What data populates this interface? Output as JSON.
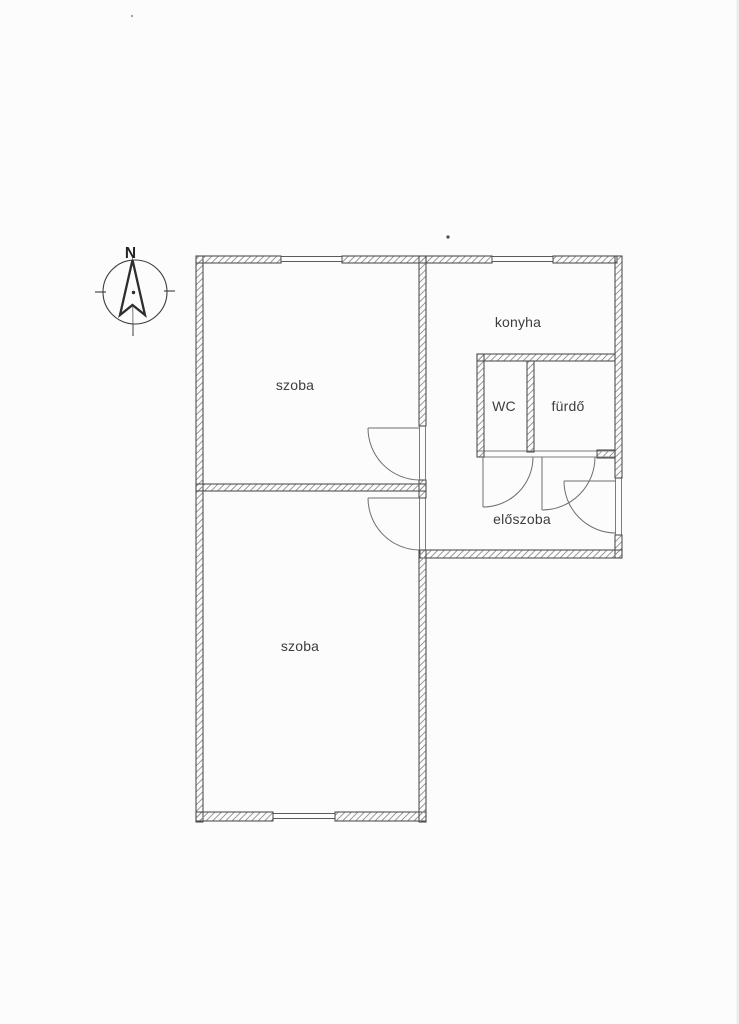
{
  "page": {
    "background": "#fcfcfc",
    "ink": "#3d3d3d",
    "wall_hatch_color": "#8f8f8f"
  },
  "compass": {
    "north_label": "N"
  },
  "rooms": [
    {
      "id": "szoba-1",
      "label": "szoba"
    },
    {
      "id": "szoba-2",
      "label": "szoba"
    },
    {
      "id": "konyha",
      "label": "konyha"
    },
    {
      "id": "wc",
      "label": "WC"
    },
    {
      "id": "furdo",
      "label": "fürdő"
    },
    {
      "id": "eloszoba",
      "label": "előszoba"
    }
  ]
}
